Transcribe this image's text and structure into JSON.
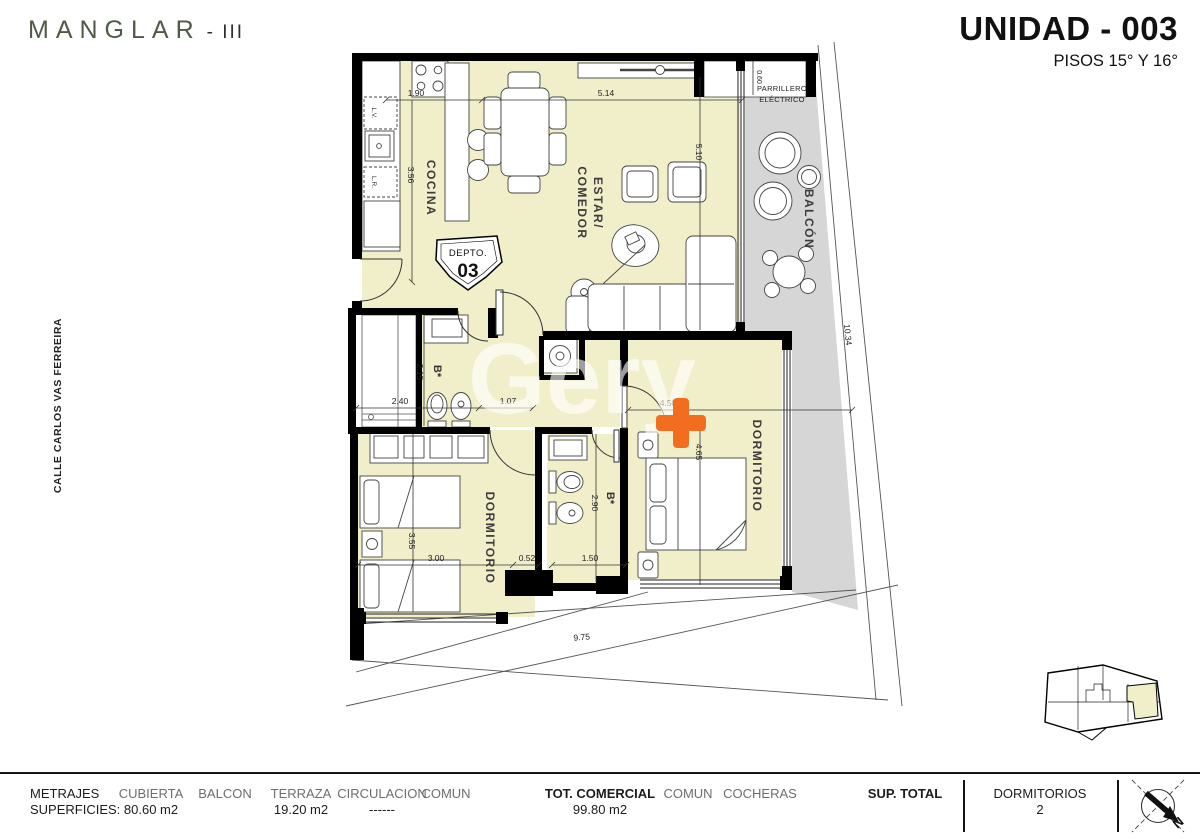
{
  "header": {
    "logo": "MANGLAR",
    "logo_suffix": "- III",
    "unit": "UNIDAD - 003",
    "floors": "PISOS 15° Y 16°"
  },
  "side": {
    "street": "CALLE CARLOS VAS FERREIRA"
  },
  "watermark": {
    "text": "Gery"
  },
  "plan": {
    "badge": {
      "small": "DEPTO.",
      "big": "03"
    },
    "rooms": {
      "kitchen": "COCINA",
      "living1": "ESTAR/",
      "living2": "COMEDOR",
      "balcony": "BALCÓN",
      "grill1": "PARRILLERO",
      "grill2": "ELÉCTRICO",
      "bath1": "B*",
      "bath2": "B*",
      "bedroom1": "DORMITORIO",
      "bedroom2": "DORMITORIO"
    },
    "labels": {
      "lv": "L.V.",
      "lr": "L.R."
    },
    "dims": {
      "kitchen_w": "1.90",
      "kitchen_d": "3.56",
      "living_w": "5.14",
      "living_d": "5.10",
      "grill": "0.60",
      "balcony": "10.34",
      "closet": "2.40",
      "bath1": "2.15",
      "hall": "1.07",
      "bed1_w": "4.50",
      "bed1_d": "4.65",
      "bath2_d": "2.90",
      "bed2_d": "3.55",
      "bed2_w": "3.00",
      "step": "0.52",
      "bath2_w": "1.50",
      "front": "9.75"
    },
    "colors": {
      "interior": "#f1eeca",
      "balcony": "#d6d6d6",
      "wall": "#000000",
      "orange": "#f26d1f",
      "logo_green": "#4e5b45"
    }
  },
  "footer": {
    "metrajes": {
      "l1": "METRAJES",
      "l2": "SUPERFICIES:"
    },
    "cubierta": {
      "label": "CUBIERTA",
      "value": "80.60 m2"
    },
    "balcon": {
      "label": "BALCON",
      "value": ""
    },
    "terraza": {
      "label": "TERRAZA",
      "value": "19.20 m2"
    },
    "circulacion": {
      "label": "CIRCULACION",
      "value": "------"
    },
    "comun1": {
      "label": "COMUN",
      "value": ""
    },
    "tot_comercial": {
      "label": "TOT. COMERCIAL",
      "value": "99.80 m2"
    },
    "comun2": {
      "label": "COMUN",
      "value": ""
    },
    "cocheras": {
      "label": "COCHERAS",
      "value": ""
    },
    "sup_total": {
      "label": "SUP. TOTAL",
      "value": ""
    },
    "dormitorios": {
      "label": "DORMITORIOS",
      "value": "2"
    },
    "compass_n": "N"
  }
}
